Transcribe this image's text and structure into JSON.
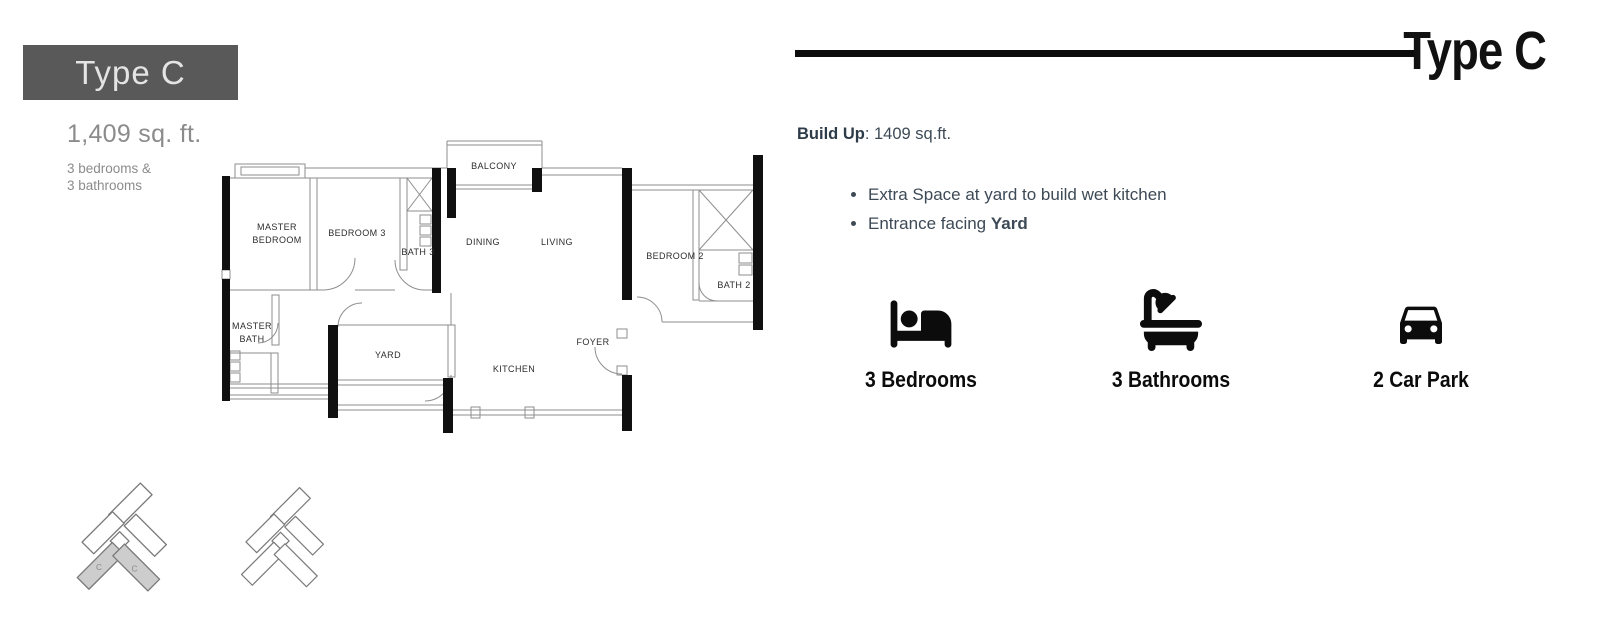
{
  "left_panel": {
    "type_label": "Type C",
    "area": "1,409 sq. ft.",
    "spec_line1": "3 bedrooms &",
    "spec_line2": "3 bathrooms"
  },
  "floorplan": {
    "rooms": {
      "balcony": "BALCONY",
      "master_bedroom_l1": "MASTER",
      "master_bedroom_l2": "BEDROOM",
      "bedroom3": "BEDROOM 3",
      "bath3": "BATH 3",
      "dining": "DINING",
      "living": "LIVING",
      "bedroom2": "BEDROOM 2",
      "bath2": "BATH 2",
      "master_bath_l1": "MASTER",
      "master_bath_l2": "BATH",
      "yard": "YARD",
      "kitchen": "KITCHEN",
      "foyer": "FOYER"
    },
    "site_key": {
      "unit_label": "C"
    }
  },
  "right_panel": {
    "title": "Type C",
    "build_up_label": "Build Up",
    "build_up_value": ": 1409 sq.ft.",
    "bullets": [
      {
        "text": "Extra Space at yard to build wet kitchen",
        "bold": ""
      },
      {
        "text": "Entrance facing ",
        "bold": "Yard"
      }
    ],
    "features": [
      {
        "icon": "bed-icon",
        "label": "3 Bedrooms"
      },
      {
        "icon": "bath-icon",
        "label": "3 Bathrooms"
      },
      {
        "icon": "car-icon",
        "label": "2 Car Park"
      }
    ],
    "colors": {
      "box_gray": "#595959",
      "muted_gray": "#8b8b8b",
      "text_dark": "#3d4a56",
      "title_black": "#111111"
    }
  }
}
